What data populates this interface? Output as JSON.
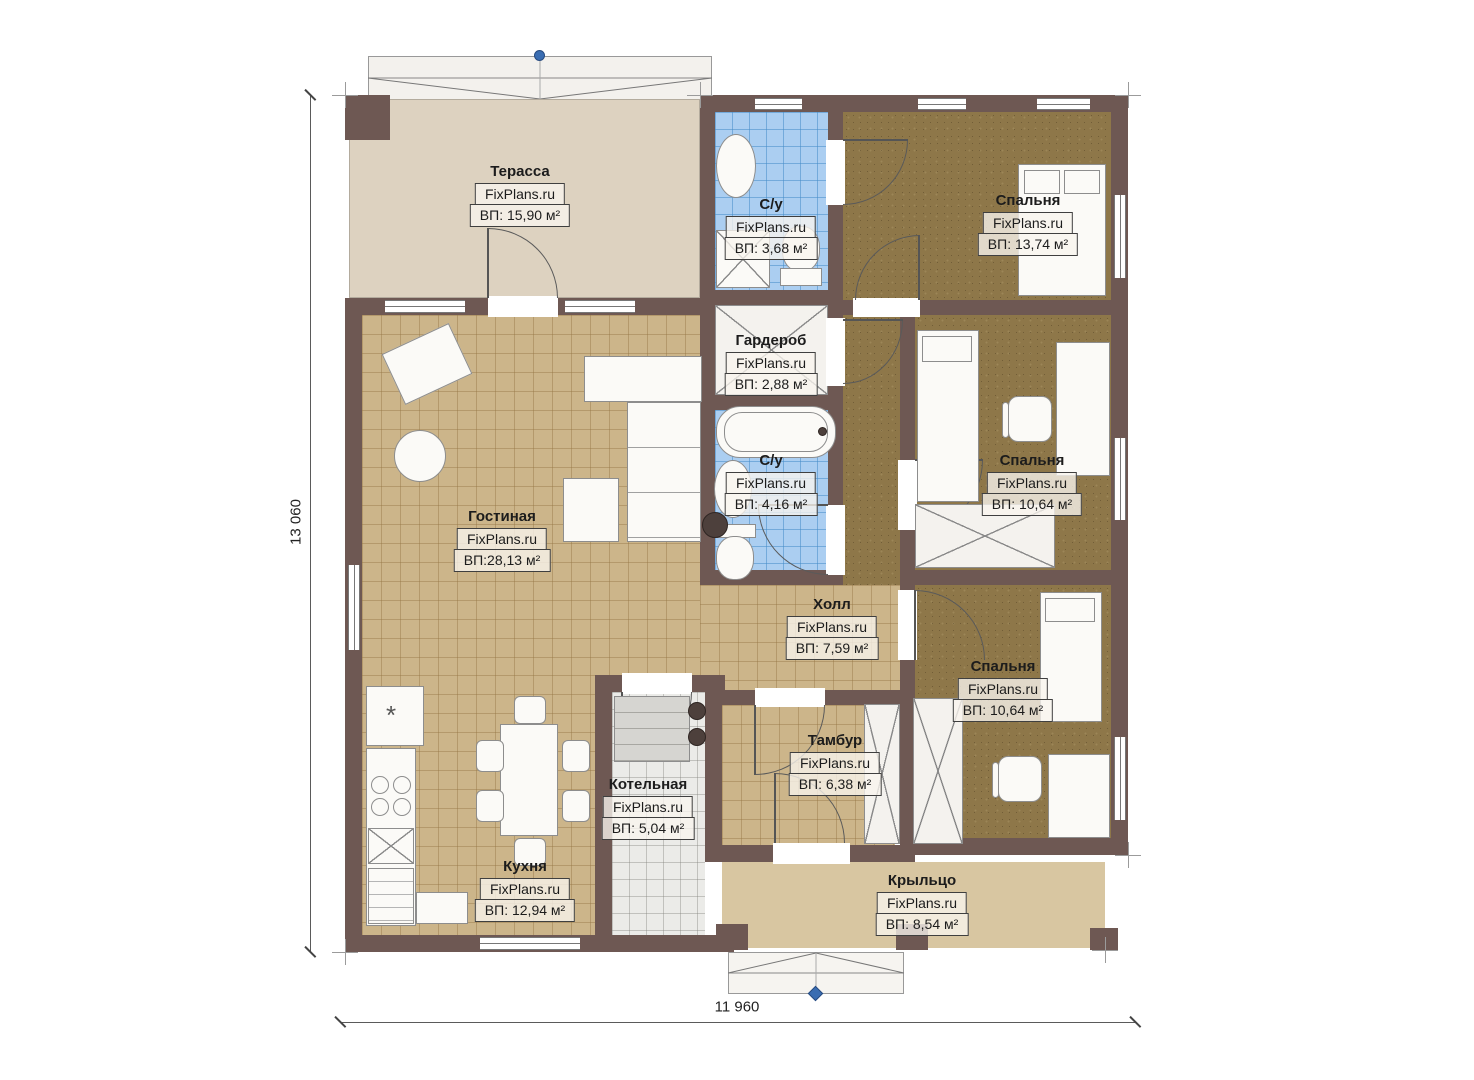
{
  "watermark": "FixPlans.ru",
  "dimensions": {
    "height": "13 060",
    "width": "11 960"
  },
  "rooms": [
    {
      "name": "Терасса",
      "area": "ВП: 15,90 м²"
    },
    {
      "name": "С/у",
      "area": "ВП: 3,68 м²"
    },
    {
      "name": "Спальня",
      "area": "ВП: 13,74 м²"
    },
    {
      "name": "Гардероб",
      "area": "ВП: 2,88 м²"
    },
    {
      "name": "С/у",
      "area": "ВП: 4,16 м²"
    },
    {
      "name": "Гостиная",
      "area": "ВП:28,13 м²"
    },
    {
      "name": "Спальня",
      "area": "ВП: 10,64 м²"
    },
    {
      "name": "Холл",
      "area": "ВП: 7,59 м²"
    },
    {
      "name": "Спальня",
      "area": "ВП: 10,64 м²"
    },
    {
      "name": "Тамбур",
      "area": "ВП: 6,38 м²"
    },
    {
      "name": "Котельная",
      "area": "ВП: 5,04 м²"
    },
    {
      "name": "Кухня",
      "area": "ВП: 12,94 м²"
    },
    {
      "name": "Крыльцо",
      "area": "ВП: 8,54 м²"
    }
  ],
  "colors": {
    "wall": "#6e5853",
    "tile_tan": "#ccb58a",
    "carpet_brown": "#8e7749",
    "tile_blue": "#abcef1",
    "terrace_floor": "#ddd2c0",
    "porch_floor": "#d8c6a1",
    "boiler_floor": "#ebebe8",
    "closet_fill": "#f4f2ee",
    "marker_blue": "#3a6db2"
  }
}
